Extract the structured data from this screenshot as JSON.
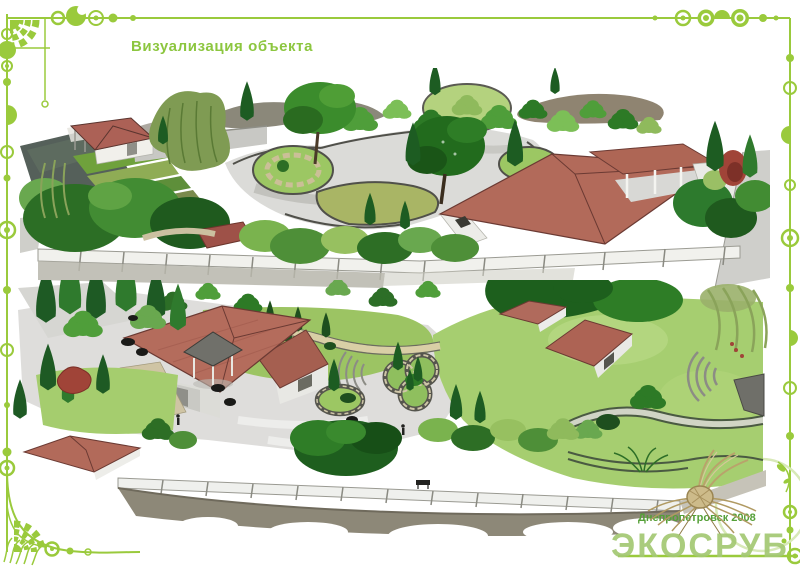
{
  "page": {
    "title": "Визуализация объекта"
  },
  "footer": {
    "city_year": "Днепропетровск 2008",
    "logo_text": "ЭКОСРУБ"
  },
  "palette": {
    "border_green": "#9ACA3C",
    "title_green": "#8CC63F",
    "logo_green": "#A3C873",
    "footer_green": "#55A038",
    "roof_red": "#B26A5A",
    "wall_white": "#EFEFEC",
    "path_gray": "#DCDCDA",
    "lawn_bright": "#A5CD6E",
    "lawn_mid": "#9CC763",
    "tree_dark": "#1E5E1E",
    "tree_mid": "#2F7D27",
    "tree_light": "#7CBF57",
    "willow_olive": "#8AA35A",
    "wheat_tan": "#C2AE7E",
    "road_brown": "#8D8878"
  },
  "illustrations": {
    "top_render": "garden-plan-perspective-view-1",
    "bottom_render": "garden-plan-perspective-view-2",
    "border": "art-nouveau-circle-ornament-border",
    "wheat_sheaf": "dried-grass-sheaf-sketch"
  }
}
